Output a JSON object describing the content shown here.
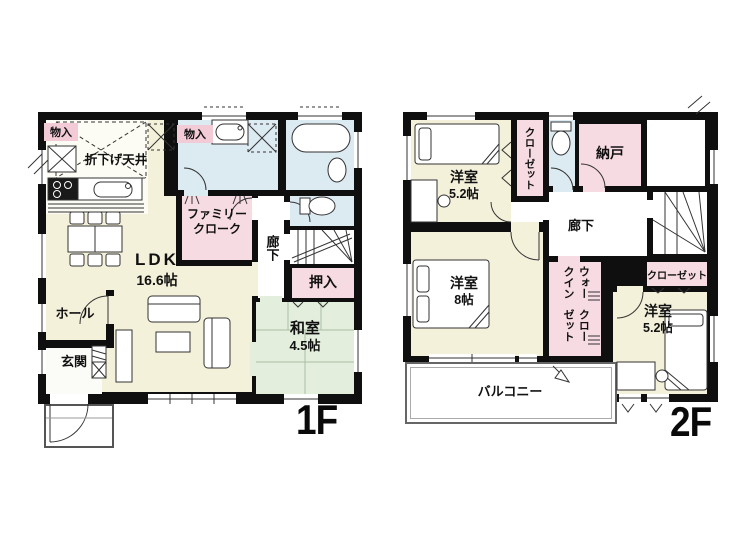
{
  "palette": {
    "wall": "#0f0f0f",
    "room_yellow": "#f4f1da",
    "room_green": "#e3eedd",
    "room_blue": "#dceaf2",
    "room_pink": "#f7dbe3",
    "label_pink": "#f3cbd7"
  },
  "f1": {
    "floor_label": "1F",
    "labels": {
      "monoiri_left": "物入",
      "monoiri_mid": "物入",
      "orisage_tenjo": "折下げ天井",
      "family_cloak_1": "ファミリー",
      "family_cloak_2": "クローク",
      "rouka": "廊下",
      "oshiire": "押入",
      "ldk_name": "LDK",
      "ldk_size": "16.6帖",
      "washitsu_name": "和室",
      "washitsu_size": "4.5帖",
      "hall": "ホール",
      "genkan": "玄関"
    }
  },
  "f2": {
    "floor_label": "2F",
    "labels": {
      "bed1_name": "洋室",
      "bed1_size": "5.2帖",
      "closet1": "クローゼット",
      "nando": "納戸",
      "rouka": "廊下",
      "bed2_name": "洋室",
      "bed2_size": "8帖",
      "wic_1": "ウォークイン",
      "wic_2": "クローゼット",
      "closet2": "クローゼット",
      "bed3_name": "洋室",
      "bed3_size": "5.2帖",
      "balcony": "バルコニー"
    }
  }
}
